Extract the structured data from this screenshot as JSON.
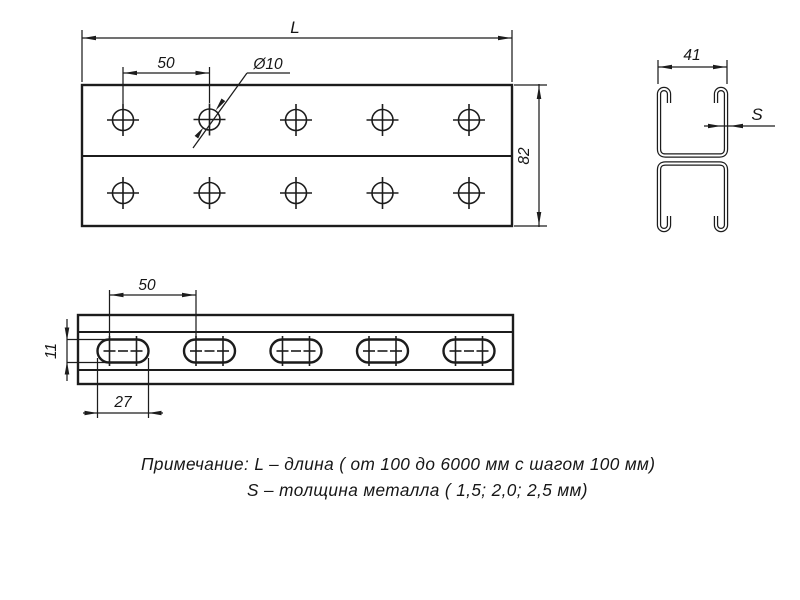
{
  "drawing": {
    "front_view": {
      "dim_length": "L",
      "dim_hole_spacing": "50",
      "dim_hole_diameter": "Ø10",
      "dim_height": "82"
    },
    "profile_view": {
      "dim_width": "41",
      "dim_thickness": "S"
    },
    "side_view": {
      "dim_slot_spacing": "50",
      "dim_slot_height": "11",
      "dim_slot_length": "27"
    },
    "note": {
      "line1": "Примечание: L – длина ( от 100 до 6000 мм с шагом 100 мм)",
      "line2": "S – толщина металла ( 1,5; 2,0; 2,5 мм)"
    },
    "colors": {
      "line": "#1c1c1c",
      "background": "#ffffff"
    }
  }
}
